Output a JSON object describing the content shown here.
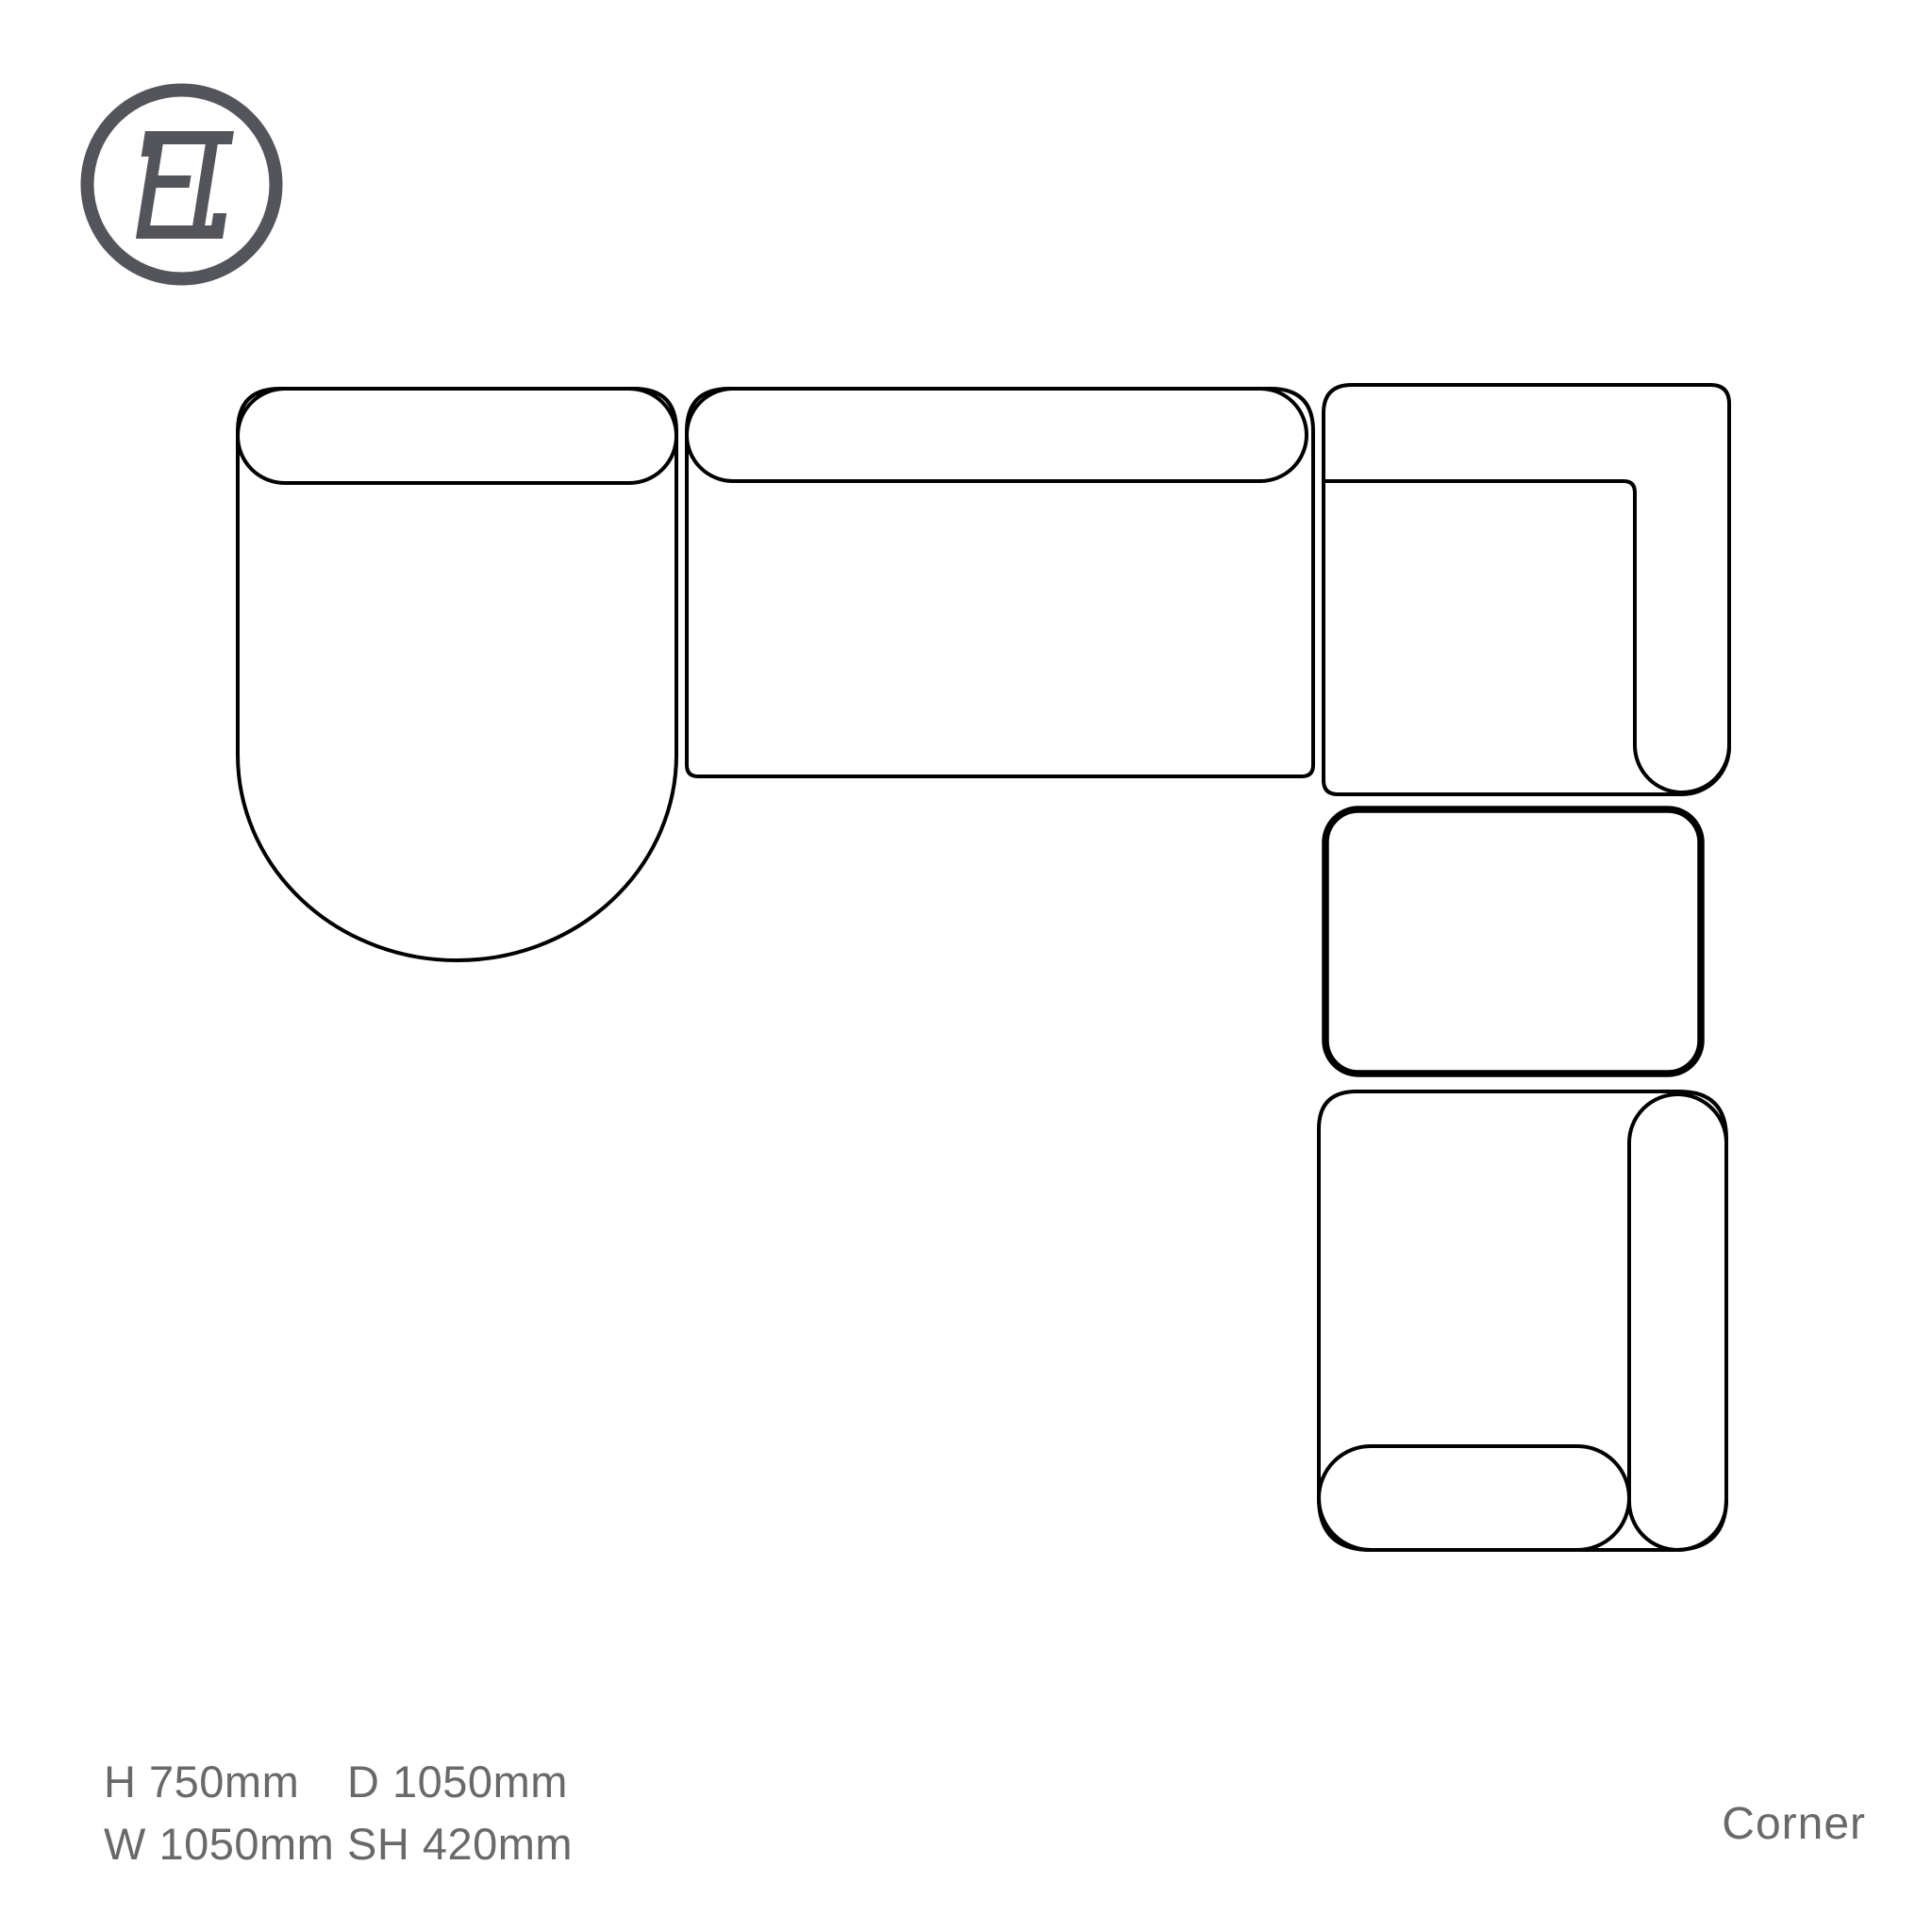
{
  "logo": {
    "monogram": "FI",
    "color": "#54555a",
    "shape": "circle-ring"
  },
  "diagram": {
    "description": "Top-down plan drawing of a corner sectional sofa configuration",
    "stroke_color": "#000000",
    "highlight_stroke_color": "#000000",
    "modules": [
      {
        "name": "chaise-end-module",
        "position": "top-left",
        "features": [
          "back-cushion-top",
          "curved-front-end"
        ],
        "highlighted": false
      },
      {
        "name": "armless-seat-module",
        "position": "top-middle",
        "features": [
          "back-cushion-top"
        ],
        "highlighted": false
      },
      {
        "name": "corner-back-module",
        "position": "top-right",
        "features": [
          "l-shaped-back"
        ],
        "highlighted": false
      },
      {
        "name": "highlighted-module",
        "position": "right-middle",
        "features": [
          "bold-outline"
        ],
        "highlighted": true
      },
      {
        "name": "arm-end-module",
        "position": "bottom-right",
        "features": [
          "back-cushion-right",
          "arm-bottom"
        ],
        "highlighted": false
      }
    ]
  },
  "specs": {
    "text_color": "#696969",
    "entries": [
      {
        "label": "H",
        "value": "750mm"
      },
      {
        "label": "W",
        "value": "1050mm"
      },
      {
        "label": "D",
        "value": "1050mm"
      },
      {
        "label": "SH",
        "value": "420mm"
      }
    ]
  },
  "title": {
    "text": "Corner"
  }
}
